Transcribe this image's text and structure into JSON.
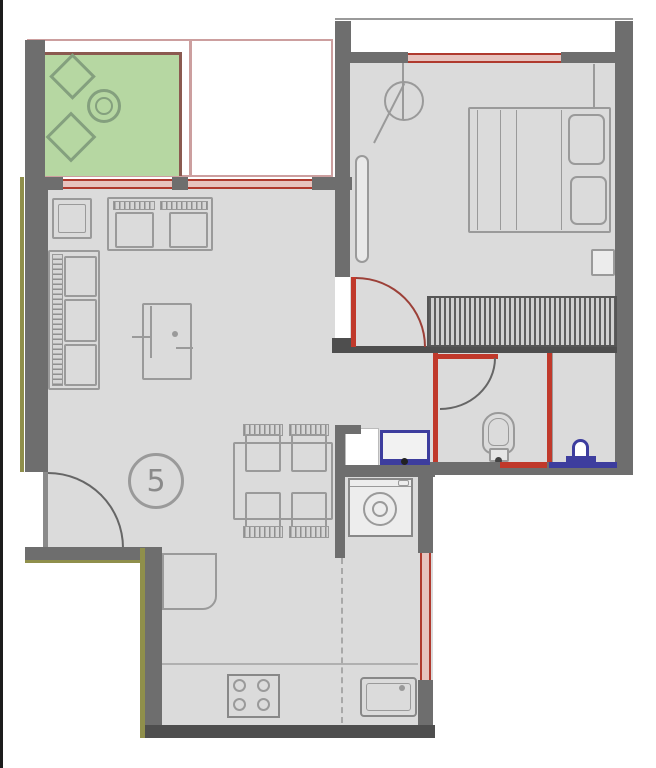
{
  "meta": {
    "type": "apartment-floor-plan",
    "unit_label": "5"
  },
  "colors": {
    "edge_black": "#1c1c1c",
    "wall": "#6e6e6e",
    "wall_dark": "#4e4e4e",
    "floor": "#dbdbdb",
    "furniture_outline": "#9a9a9a",
    "window_red": "#b03a2e",
    "window_fill": "#e7c3be",
    "plumbing_red": "#c0392b",
    "fixture_blue": "#3d3d9e",
    "balcony_green": "#b6d7a2",
    "balcony_outline": "#84a07e",
    "balcony_brown": "#8b5a50",
    "terrace_line": "#cc9f9f",
    "accent_olive": "#8f8f4b",
    "door_arc": "#9c4038",
    "label_gray": "#8a8a8a"
  },
  "rooms": [
    {
      "id": "balcony",
      "name": "covered balcony (green)"
    },
    {
      "id": "terrace",
      "name": "open terrace (outline)"
    },
    {
      "id": "bedroom",
      "name": "bedroom"
    },
    {
      "id": "living-dining",
      "name": "living / dining room"
    },
    {
      "id": "hallway",
      "name": "hallway"
    },
    {
      "id": "bathroom",
      "name": "bathroom"
    },
    {
      "id": "wc",
      "name": "wc / shower room"
    },
    {
      "id": "laundry",
      "name": "laundry nook"
    },
    {
      "id": "kitchen",
      "name": "kitchen"
    }
  ],
  "furniture": [
    "lounge-chair",
    "garden-table",
    "double-bed",
    "pillows",
    "nightstand",
    "ceiling-lamp",
    "radiator",
    "wardrobe",
    "sofa-2-seat",
    "sofa-3-seat",
    "side-table",
    "tv-unit",
    "dining-table",
    "dining-chair",
    "entrance-door",
    "toilet",
    "washbasin",
    "bidet",
    "washing-machine",
    "kitchen-counter",
    "stove",
    "kitchen-sink",
    "kitchen-table"
  ]
}
